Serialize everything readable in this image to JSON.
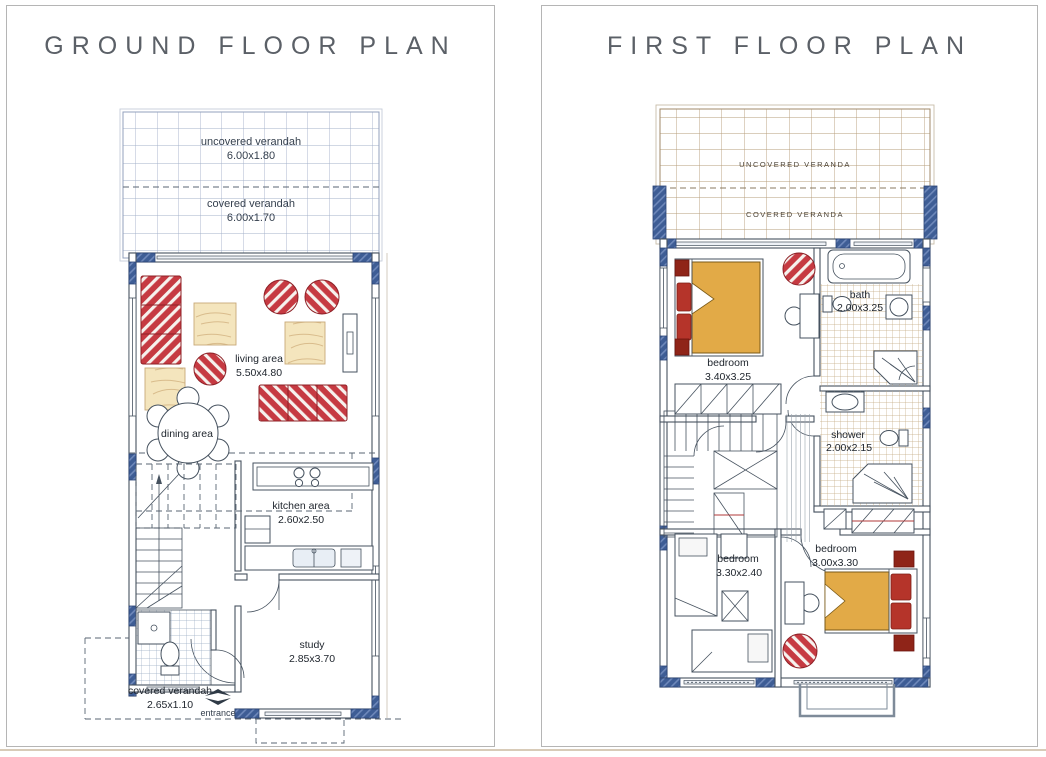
{
  "ground_floor": {
    "title": "GROUND FLOOR PLAN",
    "rooms": {
      "uncovered_verandah": {
        "label": "uncovered verandah",
        "size": "6.00x1.80"
      },
      "covered_verandah": {
        "label": "covered verandah",
        "size": "6.00x1.70"
      },
      "living_area": {
        "label": "living area",
        "size": "5.50x4.80"
      },
      "dining_area": {
        "label": "dining area"
      },
      "kitchen_area": {
        "label": "kitchen area",
        "size": "2.60x2.50"
      },
      "study": {
        "label": "study",
        "size": "2.85x3.70"
      },
      "front_covered_verandah": {
        "label": "covered verandah",
        "size": "2.65x1.10"
      },
      "entrance": {
        "label": "entrance"
      }
    }
  },
  "first_floor": {
    "title": "FIRST FLOOR PLAN",
    "rooms": {
      "uncovered_veranda": {
        "label": "UNCOVERED VERANDA"
      },
      "covered_veranda": {
        "label": "COVERED VERANDA"
      },
      "bedroom_main": {
        "label": "bedroom",
        "size": "3.40x3.25"
      },
      "bath": {
        "label": "bath",
        "size": "2.00x3.25"
      },
      "shower": {
        "label": "shower",
        "size": "2.00x2.15"
      },
      "bedroom_left": {
        "label": "bedroom",
        "size": "3.30x2.40"
      },
      "bedroom_right": {
        "label": "bedroom",
        "size": "3.00x3.30"
      }
    }
  },
  "colors": {
    "title_text": "#5b6067",
    "panel_border": "#b5b5b5",
    "plan_line": "#46525f",
    "wall_block_blue": "#3e5d95",
    "verandah_grid_blue": "#a3b0ca",
    "veranda_grid_tan": "#b59c79",
    "furniture_red": "#c63a42",
    "pillow_red": "#b5342a",
    "bed_gold": "#e2aa47",
    "wood_fill": "#f4e5bd",
    "scan_edge_tan": "#d8cbb8"
  }
}
